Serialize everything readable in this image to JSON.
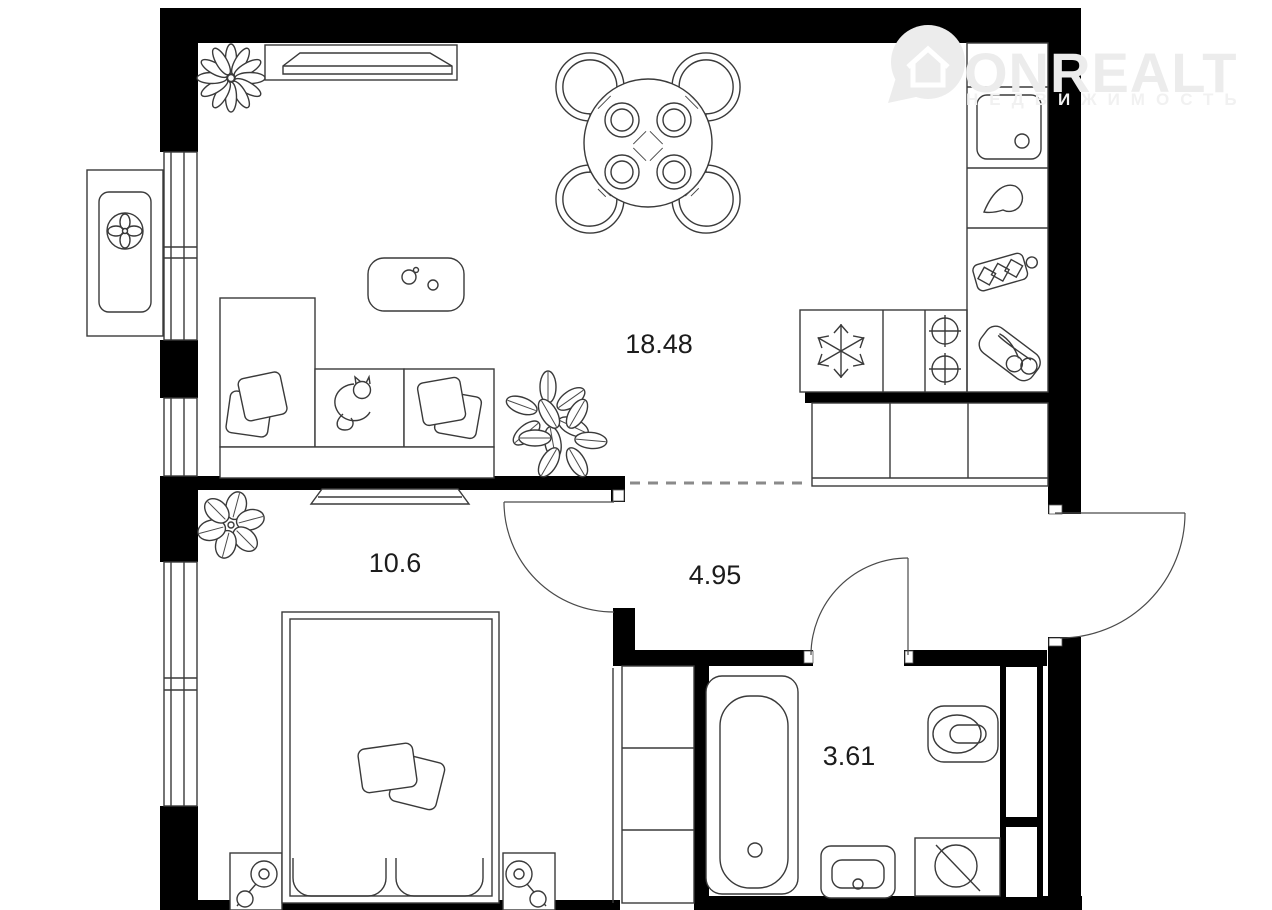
{
  "watermark": {
    "brand": "ONREALT",
    "subtitle": "НЕДВИЖИМОСТЬ",
    "color": "#ececec"
  },
  "rooms": [
    {
      "name": "living-room-kitchen",
      "area_label": "18.48"
    },
    {
      "name": "bedroom",
      "area_label": "10.6"
    },
    {
      "name": "hallway",
      "area_label": "4.95"
    },
    {
      "name": "bathroom",
      "area_label": "3.61"
    }
  ],
  "icons": [
    "location-pin-house-icon",
    "air-conditioner-fan-icon",
    "window",
    "balcony",
    "wall-shelf-icon",
    "flower-icon",
    "dining-table-icon",
    "chair-icon",
    "place-setting-icon",
    "coffee-table-icon",
    "sofa-icon",
    "pillow-icon",
    "cat-icon",
    "plant-icon",
    "kitchen-sink-icon",
    "drop-icon",
    "cutting-board-icon",
    "fruit-tray-icon",
    "fridge-snowflake-icon",
    "stove-burners-icon",
    "wardrobe-icon",
    "door-swing-arc",
    "tv-shelf-icon",
    "bed-icon",
    "nightstand-lamp-icon",
    "bathtub-icon",
    "toilet-icon",
    "washbasin-icon",
    "washing-machine-icon",
    "ventilation-shaft"
  ],
  "colors": {
    "wall": "#000000",
    "outline": "#3a3a3a",
    "label": "#1c1c1c",
    "background": "#ffffff",
    "watermark": "#ececec",
    "dashed_opening": "#8a8a8a"
  }
}
